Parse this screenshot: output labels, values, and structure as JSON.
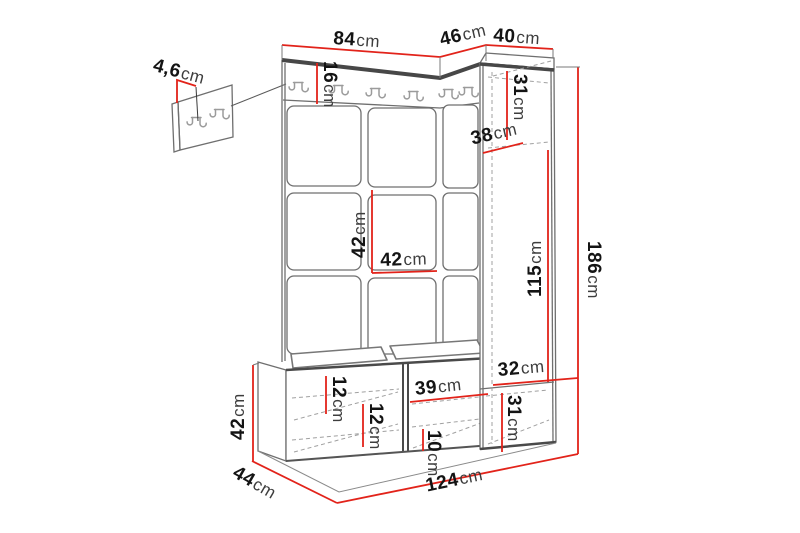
{
  "diagram": {
    "kind": "furniture-dimension-diagram",
    "unit_label": "cm"
  },
  "colors": {
    "dimension_red": "#e2231a",
    "outline_gray": "#6f6f6f",
    "edge_dark": "#474747",
    "dashed_gray": "#a0a0a0",
    "hook_gray": "#9b9b9b"
  },
  "dims": {
    "wall_panel_thickness": {
      "value": "4,6",
      "unit": "cm"
    },
    "top_left_width": {
      "value": "84",
      "unit": "cm"
    },
    "top_corner_width": {
      "value": "46",
      "unit": "cm"
    },
    "cabinet_width": {
      "value": "40",
      "unit": "cm"
    },
    "hook_rail_height": {
      "value": "16",
      "unit": "cm"
    },
    "cabinet_upper_height": {
      "value": "31",
      "unit": "cm"
    },
    "cabinet_inner_depth": {
      "value": "38",
      "unit": "cm"
    },
    "cabinet_main_height": {
      "value": "115",
      "unit": "cm"
    },
    "total_height": {
      "value": "186",
      "unit": "cm"
    },
    "panel_tile_height": {
      "value": "42",
      "unit": "cm"
    },
    "panel_tile_width": {
      "value": "42",
      "unit": "cm"
    },
    "bench_height": {
      "value": "42",
      "unit": "cm"
    },
    "unit_depth": {
      "value": "44",
      "unit": "cm"
    },
    "unit_width": {
      "value": "124",
      "unit": "cm"
    },
    "bench_upper_gap": {
      "value": "12",
      "unit": "cm"
    },
    "bench_lower_gap": {
      "value": "12",
      "unit": "cm"
    },
    "bench_right_width": {
      "value": "39",
      "unit": "cm"
    },
    "bench_right_height": {
      "value": "10",
      "unit": "cm"
    },
    "cabinet_base_width": {
      "value": "32",
      "unit": "cm"
    },
    "cabinet_base_height": {
      "value": "31",
      "unit": "cm"
    }
  }
}
